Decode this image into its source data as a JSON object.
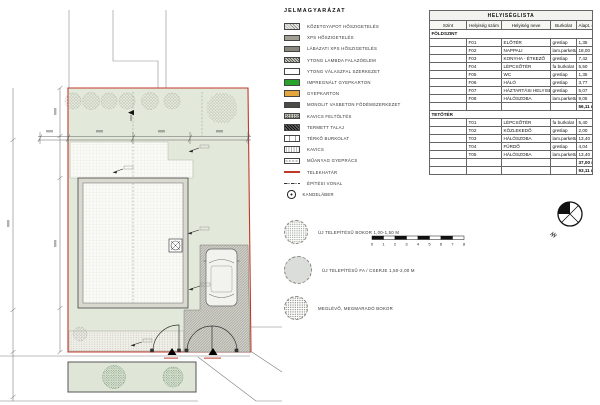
{
  "legend": {
    "title": "JELMAGYARÁZAT",
    "items": [
      {
        "symbol": "hatched-light-swatch",
        "label": "KŐZETGYAPOT HŐSZIGETELÉS"
      },
      {
        "symbol": "mid-gray-swatch",
        "label": "XPS HŐSZIGETELÉS"
      },
      {
        "symbol": "dark-gray-swatch",
        "label": "LÁBAZATI XPS HŐSZIGETELÉS"
      },
      {
        "symbol": "crosshatch-swatch",
        "label": "YTONG LAMBDA FALAZÓELEM"
      },
      {
        "symbol": "stipple-hatch-swatch",
        "label": "YTONG VÁLASZFAL SZERKEZET"
      },
      {
        "symbol": "green-swatch",
        "label": "IMPREGNÁLT GYEPKARTON"
      },
      {
        "symbol": "orange-swatch",
        "label": "GYEPKARTON"
      },
      {
        "symbol": "charcoal-swatch",
        "label": "MONOLIT VASBETON FÖDÉMSZERKEZET"
      },
      {
        "symbol": "pebble-swatch",
        "label": "KAVICS FELTÖLTÉS"
      },
      {
        "symbol": "dark-hatch-swatch",
        "label": "TERMETT TALAJ"
      },
      {
        "symbol": "brick-swatch",
        "label": "TÉRKŐ BURKOLAT"
      },
      {
        "symbol": "dots-swatch",
        "label": "KAVICS"
      },
      {
        "symbol": "oval-grid-swatch",
        "label": "MŰANYAG GYEPRÁCS"
      },
      {
        "symbol": "red-line",
        "label": "TELEKHATÁR"
      },
      {
        "symbol": "dash-dot-line",
        "label": "ÉPÍTÉSI VONAL"
      },
      {
        "symbol": "lamp-circle",
        "label": "KANDELÁBER"
      }
    ],
    "plant_symbols": [
      {
        "symbol": "new-bush",
        "label": "ÚJ TELEPÍTÉSŰ BOKOR 1,00-1,50 M"
      },
      {
        "symbol": "new-tree-shrub",
        "label": "ÚJ TELEPÍTÉSŰ FA / CSERJE 1,50-2,00 M"
      },
      {
        "symbol": "existing-bush",
        "label": "MEGLÉVŐ, MEGMARADÓ BOKOR"
      }
    ]
  },
  "scale_bar": {
    "ticks": [
      "0",
      "1",
      "2",
      "3",
      "4",
      "5",
      "6",
      "7",
      "8"
    ]
  },
  "schedule": {
    "title": "HELYISÉGLISTA",
    "columns": [
      "Szint",
      "Helyiség szám",
      "Helyiség neve",
      "Burkolat",
      "Alapt. (m²)"
    ],
    "sections": [
      {
        "label": "FÖLDSZINT",
        "rows": [
          [
            "F01",
            "ELŐTÉR",
            "greslap",
            "1,35"
          ],
          [
            "F02",
            "NAPPALI",
            "lam.parketta",
            "18,00"
          ],
          [
            "F03",
            "KONYHA - ÉTKEZŐ",
            "greslap",
            "7,42"
          ],
          [
            "F04",
            "LÉPCSŐTÉR",
            "fa burkolat",
            "5,50"
          ],
          [
            "F05",
            "WC",
            "greslap",
            "1,35"
          ],
          [
            "F06",
            "HÁLÓ",
            "greslap",
            "3,77"
          ],
          [
            "F07",
            "HÁZTARTÁSI HELYISÉG",
            "greslap",
            "5,07"
          ],
          [
            "F08",
            "HÁLÓSZOBA",
            "lam.parketta",
            "9,05"
          ]
        ],
        "subtotal": "56,11 m²"
      },
      {
        "label": "TETŐTÉR",
        "rows": [
          [
            "T01",
            "LÉPCSŐTÉR",
            "fa burkolat",
            "5,40"
          ],
          [
            "T02",
            "KÖZLEKEDŐ",
            "greslap",
            "2,00"
          ],
          [
            "T03",
            "HÁLÓSZOBA",
            "lam.parketta",
            "13,40"
          ],
          [
            "T04",
            "FÜRDŐ",
            "greslap",
            "4,04"
          ],
          [
            "T05",
            "HÁLÓSZOBA",
            "lam.parketta",
            "13,40"
          ]
        ],
        "subtotal": "37,00 m²"
      }
    ],
    "total": "93,11 m²"
  },
  "colors": {
    "plot_boundary_red": "#c0392b",
    "grass_green": "#e2e8da",
    "legend_green": "#29a329",
    "legend_orange": "#e6a63e"
  }
}
